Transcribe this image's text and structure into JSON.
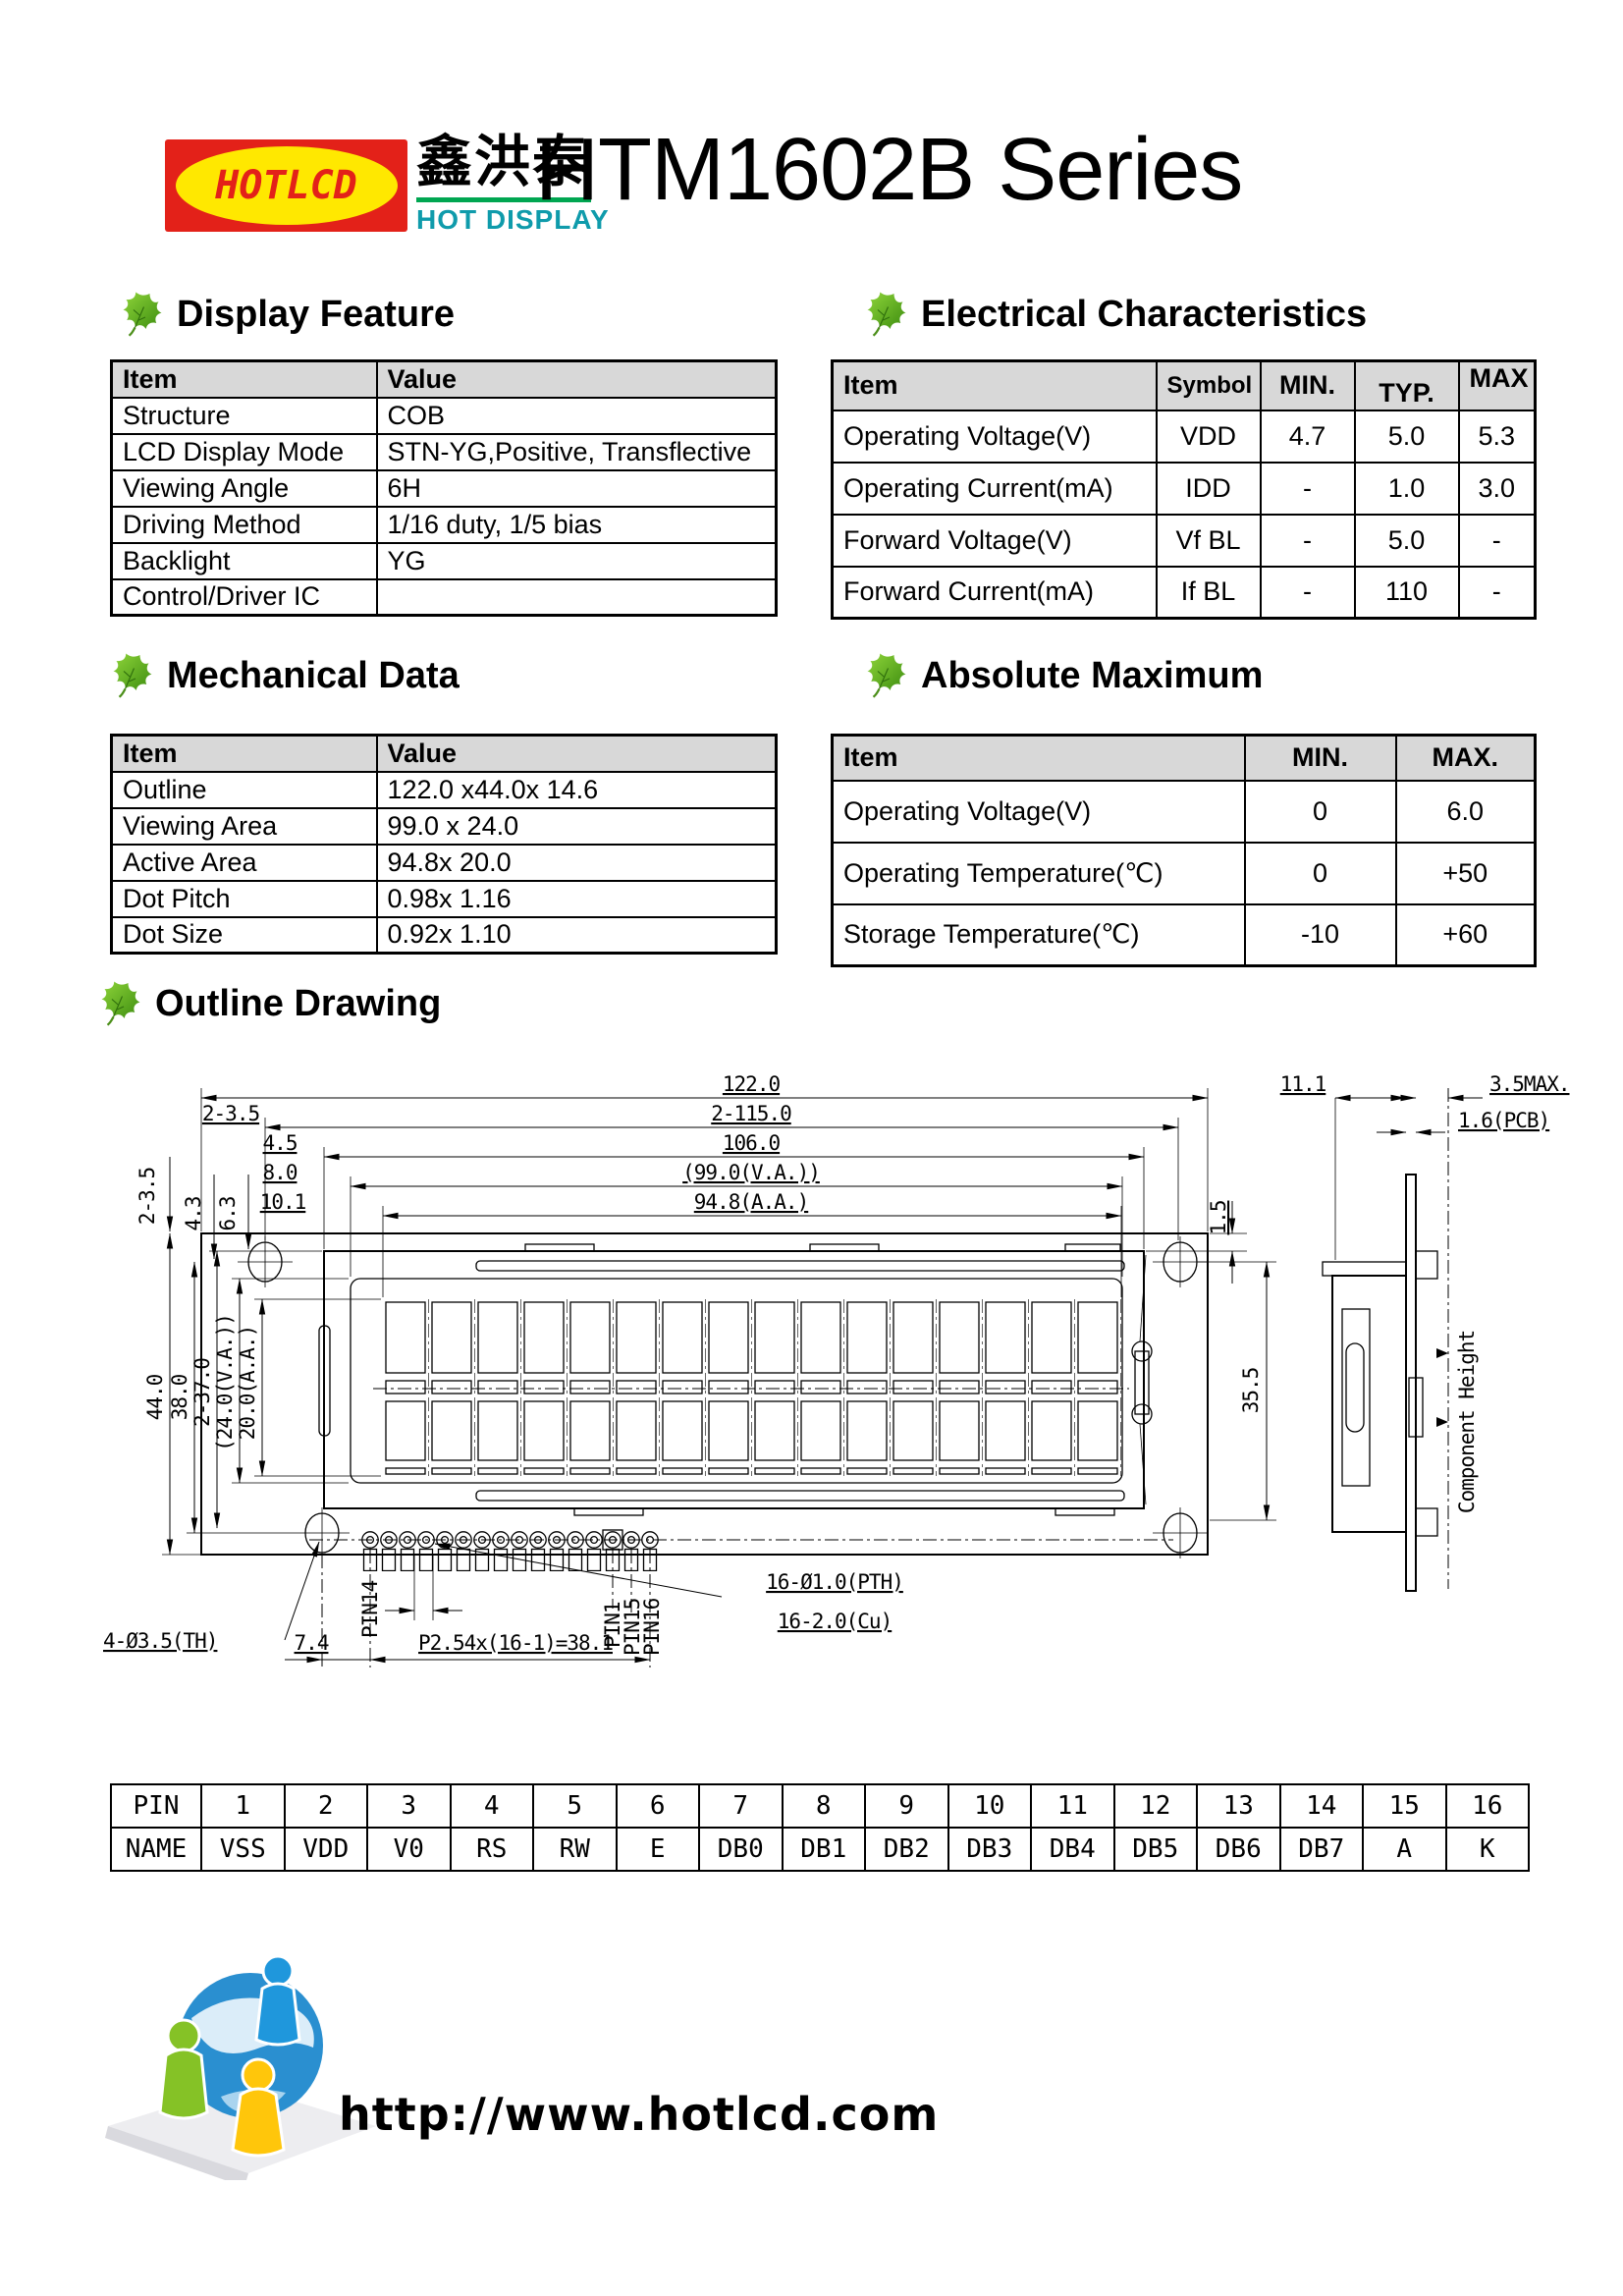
{
  "header": {
    "logo_text": "HOTLCD",
    "logo_cn": "鑫洪泰",
    "logo_sub": "HOT DISPLAY",
    "title": "HTM1602B Series"
  },
  "display_feature": {
    "title": "Display Feature",
    "headers": [
      "Item",
      "Value"
    ],
    "rows": [
      [
        "Structure",
        "COB"
      ],
      [
        "LCD Display Mode",
        "STN-YG,Positive, Transflective"
      ],
      [
        "Viewing Angle",
        "6H"
      ],
      [
        "Driving Method",
        "1/16 duty, 1/5 bias"
      ],
      [
        "Backlight",
        "YG"
      ],
      [
        "Control/Driver IC",
        ""
      ]
    ]
  },
  "electrical": {
    "title": "Electrical Characteristics",
    "headers": [
      "Item",
      "Symbol",
      "MIN.",
      "TYP.",
      "MAX"
    ],
    "rows": [
      [
        "Operating Voltage(V)",
        "VDD",
        "4.7",
        "5.0",
        "5.3"
      ],
      [
        "Operating Current(mA)",
        "IDD",
        "-",
        "1.0",
        "3.0"
      ],
      [
        "Forward Voltage(V)",
        "Vf BL",
        "-",
        "5.0",
        "-"
      ],
      [
        "Forward Current(mA)",
        "If BL",
        "-",
        "110",
        "-"
      ]
    ]
  },
  "mechanical": {
    "title": "Mechanical Data",
    "headers": [
      "Item",
      "Value"
    ],
    "rows": [
      [
        "Outline",
        "122.0 x44.0x 14.6"
      ],
      [
        "Viewing Area",
        "99.0 x 24.0"
      ],
      [
        "Active Area",
        "94.8x 20.0"
      ],
      [
        "Dot Pitch",
        "0.98x 1.16"
      ],
      [
        "Dot Size",
        "0.92x 1.10"
      ]
    ]
  },
  "absolute_maximum": {
    "title": "Absolute Maximum",
    "headers": [
      "Item",
      "MIN.",
      "MAX."
    ],
    "rows": [
      [
        "Operating Voltage(V)",
        "0",
        "6.0"
      ],
      [
        "Operating Temperature(℃)",
        "0",
        "+50"
      ],
      [
        "Storage Temperature(℃)",
        "-10",
        "+60"
      ]
    ]
  },
  "outline": {
    "title": "Outline Drawing",
    "top_dims": [
      "122.0",
      "2-115.0",
      "106.0",
      "(99.0(V.A.))",
      "94.8(A.A.)"
    ],
    "top_offsets": [
      "2-3.5",
      "4.5",
      "8.0",
      "10.1"
    ],
    "left_top_dims": [
      "2-3.5",
      "4.3",
      "6.3"
    ],
    "left_dims": [
      "44.0",
      "38.0",
      "2-37.0",
      "(24.0(V.A.))",
      "20.0(A.A.)"
    ],
    "right_dims": [
      "1.5",
      "35.5"
    ],
    "side_dims": [
      "11.1",
      "3.5MAX.",
      "1.6(PCB)"
    ],
    "component_height": "Component Height",
    "hole_label": "4-Ø3.5(TH)",
    "pin_hole_label": "16-Ø1.0(PTH)",
    "pad_label": "16-2.0(Cu)",
    "offset_label": "7.4",
    "pitch_label": "P2.54x(16-1)=38.1",
    "pin_labels": [
      "PIN14",
      "PIN1",
      "PIN15",
      "PIN16"
    ]
  },
  "pin_table": {
    "rows": [
      [
        "PIN",
        "1",
        "2",
        "3",
        "4",
        "5",
        "6",
        "7",
        "8",
        "9",
        "10",
        "11",
        "12",
        "13",
        "14",
        "15",
        "16"
      ],
      [
        "NAME",
        "VSS",
        "VDD",
        "V0",
        "RS",
        "RW",
        "E",
        "DB0",
        "DB1",
        "DB2",
        "DB3",
        "DB4",
        "DB5",
        "DB6",
        "DB7",
        "A",
        "K"
      ]
    ]
  },
  "footer": {
    "url": "http://www.hotlcd.com"
  },
  "colors": {
    "leaf_green": "#5fa71e",
    "logo_red": "#e32119",
    "logo_yellow": "#ffe800",
    "logo_teal": "#0f9bab",
    "underline_green": "#00a651",
    "table_header_bg": "#d8d8d8"
  }
}
